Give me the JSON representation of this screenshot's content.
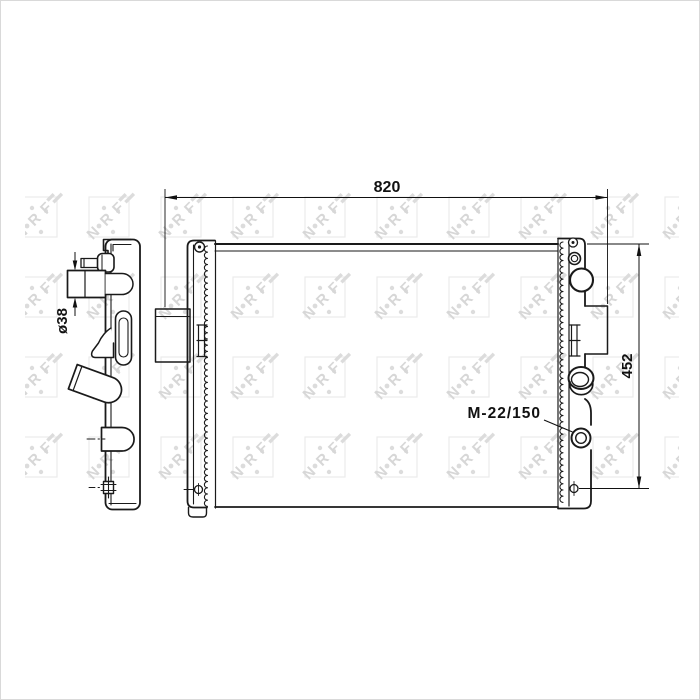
{
  "image": {
    "background": "#ffffff",
    "frame_color": "#d9d9d9",
    "line_color": "#1a1a1a",
    "subject": "radiator technical line drawing, side profile view (left) and front view (right) with dimension callouts"
  },
  "dimensions": {
    "overall_width": "820",
    "overall_height": "452",
    "inlet_diameter": "ø38",
    "port_thread": "M-22/150"
  },
  "watermark": {
    "letters": [
      "N",
      "R",
      "F"
    ],
    "letter_color": "#d7d7d7",
    "box_color": "#ebebeb"
  }
}
